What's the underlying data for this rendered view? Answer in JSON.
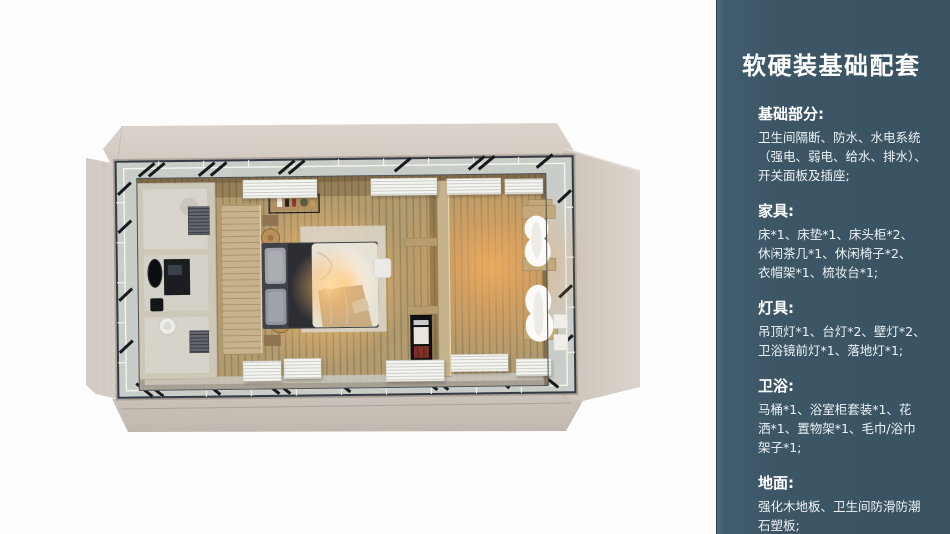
{
  "panel": {
    "title": "软硬装基础配套",
    "sections": [
      {
        "heading": "基础部分:",
        "body": "卫生间隔断、防水、水电系统\n（强电、弱电、给水、排水）、\n开关面板及插座;"
      },
      {
        "heading": "家具:",
        "body": "床*1、床垫*1、床头柜*2、\n休闲茶几*1、休闲椅子*2、\n衣帽架*1、梳妆台*1;"
      },
      {
        "heading": "灯具:",
        "body": "吊顶灯*1、台灯*2、壁灯*2、\n卫浴镜前灯*1、落地灯*1;"
      },
      {
        "heading": "卫浴:",
        "body": "马桶*1、浴室柜套装*1、花\n洒*1、置物架*1、毛巾/浴巾\n架子*1;"
      },
      {
        "heading": "地面:",
        "body": "强化木地板、卫生间防滑防潮\n石塑板;"
      }
    ],
    "colors": {
      "panel_bg": "#3c5666",
      "panel_edge": "#4e6a7a",
      "text": "#ffffff",
      "deck_beige": "#d8d0c8",
      "floor_wood": "#b29b6e",
      "warm_glow": "#fcba68"
    }
  }
}
